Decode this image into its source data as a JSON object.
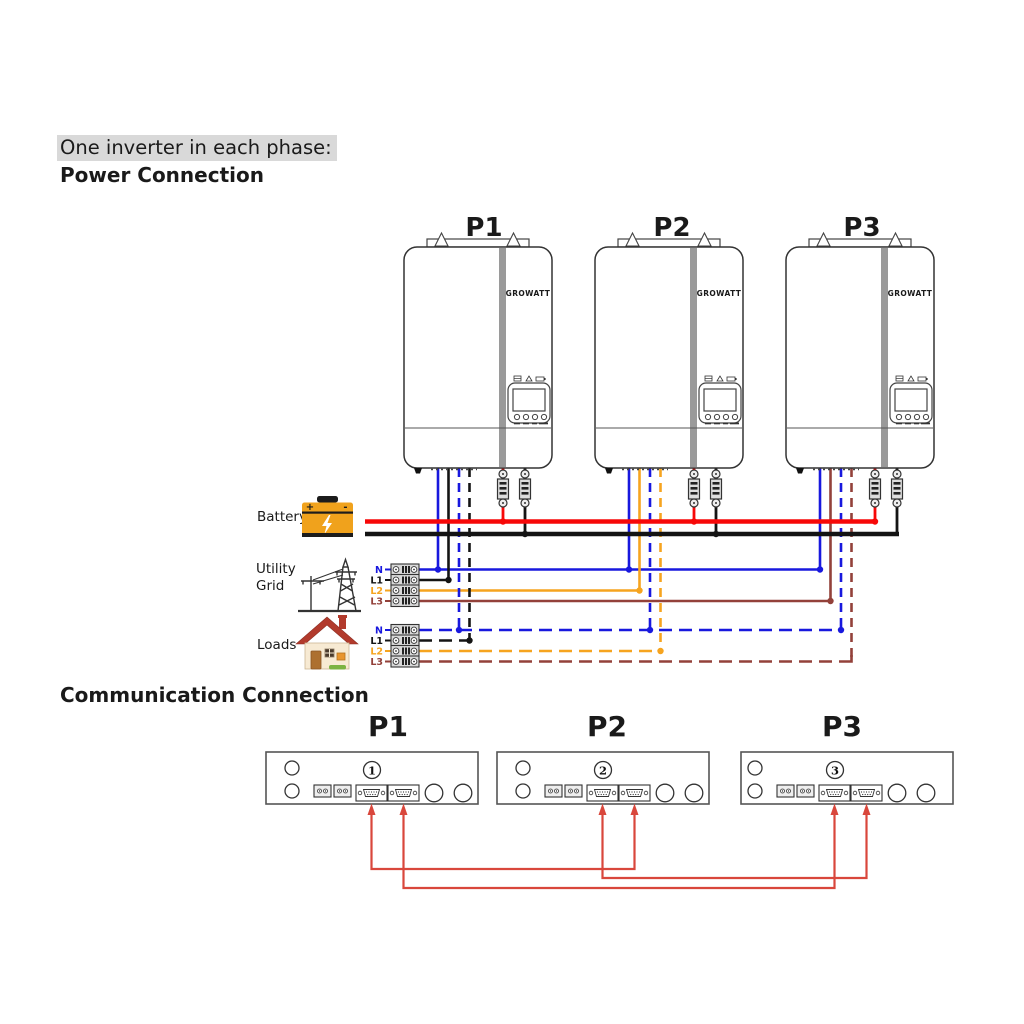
{
  "headings": {
    "subtitle": "One inverter in each phase:",
    "power": "Power Connection",
    "communication": "Communication Connection"
  },
  "inverters": {
    "brand": "GROWATT",
    "units": [
      {
        "label": "P1",
        "phase": "L1"
      },
      {
        "label": "P2",
        "phase": "L2"
      },
      {
        "label": "P3",
        "phase": "L3"
      }
    ]
  },
  "battery": {
    "label": "Battery",
    "plus": "+",
    "minus": "-"
  },
  "utility_grid": {
    "label": "Utility Grid",
    "lines": [
      "N",
      "L1",
      "L2",
      "L3"
    ]
  },
  "loads": {
    "label": "Loads",
    "lines": [
      "N",
      "L1",
      "L2",
      "L3"
    ]
  },
  "communication": {
    "units": [
      {
        "label": "P1",
        "number": "1"
      },
      {
        "label": "P2",
        "number": "2"
      },
      {
        "label": "P3",
        "number": "3"
      }
    ],
    "links": [
      {
        "from": "P1-port-1",
        "to": "P2-port-2"
      },
      {
        "from": "P2-port-1",
        "to": "P3-port-2"
      },
      {
        "from": "P1-port-2",
        "to": "P3-port-1"
      }
    ]
  },
  "colors": {
    "wire-n": "#1818de",
    "wire-l1": "#141414",
    "wire-l2": "#f6a41f",
    "wire-l3": "#93413a",
    "battery-pos": "#f70808",
    "battery-neg": "#141414",
    "comm-wire": "#d9473c",
    "highlight": "#d9d9d9",
    "stripe": "#9a9a9a",
    "battery-icon": "#f0a21c",
    "house-roof": "#b23a2c",
    "bush": "#7cb342"
  }
}
